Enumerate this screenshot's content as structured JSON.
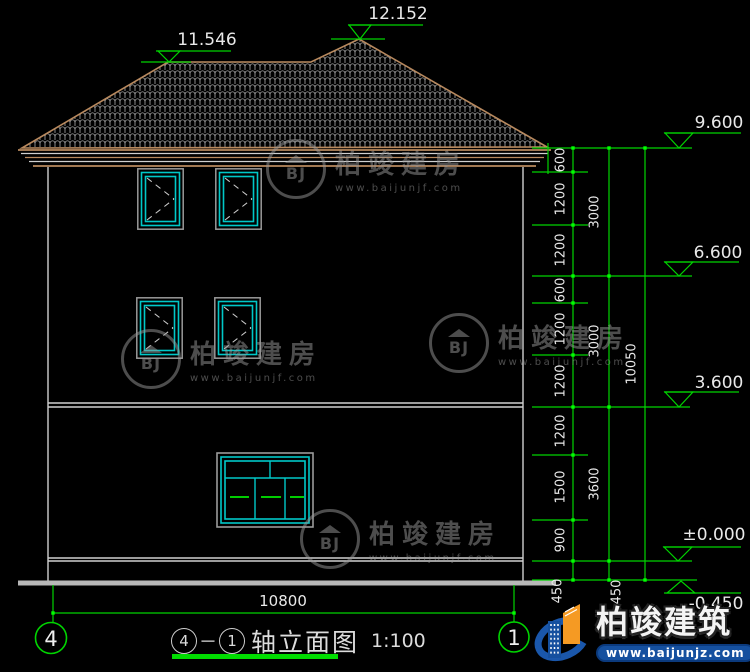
{
  "colors": {
    "dim_green": "#00d400",
    "tick_green": "#00ff00",
    "window_cyan": "#00c8c8",
    "roof_tan": "#b8895e",
    "dim_text": "#e9e9e9",
    "logo_blue": "#15509f",
    "logo_orange": "#f59a23"
  },
  "levels": {
    "ridge_main": "12.152",
    "ridge_low": "11.546",
    "eave": "9.600",
    "floor3": "6.600",
    "floor2": "3.600",
    "zero": "±0.000",
    "site": "-0.450"
  },
  "dims": {
    "chain_segments": [
      "600",
      "1200",
      "1200",
      "600",
      "1200",
      "1200",
      "1200",
      "1500",
      "900",
      "450"
    ],
    "chain_totals": [
      "3000",
      "3000",
      "3600",
      "450"
    ],
    "overall_height": "10050",
    "overall_width": "10800"
  },
  "axes": {
    "left": "4",
    "right": "1"
  },
  "title": {
    "separator": "－",
    "name": "轴立面图",
    "scale": "1:100"
  },
  "watermark": {
    "monogram": "BJ",
    "brand": "柏竣建房",
    "url": "www.baijunjf.com"
  },
  "logo": {
    "brand": "柏竣建筑",
    "url": "www.baijunjz.com"
  }
}
